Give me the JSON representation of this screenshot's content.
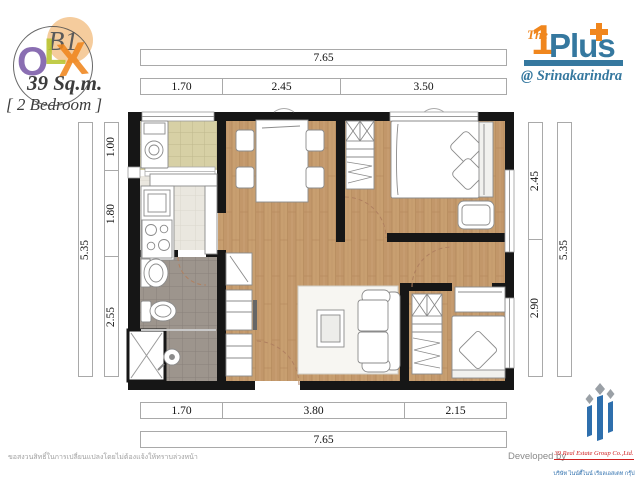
{
  "unit": {
    "code": "B1",
    "area": "39 Sq.m.",
    "type": "[ 2 Bedroom ]"
  },
  "watermark": {
    "letters": [
      "O",
      "L",
      "X"
    ]
  },
  "project": {
    "the": "The",
    "number": "1",
    "name": "Plus",
    "location": "@ Srinakarindra"
  },
  "dimensions": {
    "top_total": "7.65",
    "top_segments": [
      "1.70",
      "2.45",
      "3.50"
    ],
    "left_total": "5.35",
    "left_segments": [
      "1.00",
      "1.80",
      "2.55"
    ],
    "right_segments": [
      "2.45",
      "2.90"
    ],
    "right_total": "5.35",
    "bottom_segments": [
      "1.70",
      "3.80",
      "2.15"
    ],
    "bottom_total": "7.65"
  },
  "footer": {
    "disclaimer": "ขอสงวนสิทธิ์ในการเปลี่ยนแปลงโดยไม่ต้องแจ้งให้ทราบล่วงหน้า",
    "developed_by": "Developed by",
    "company_en": "39 Real Estate Group Co.,Ltd.",
    "company_th": "บริษัท ไนน์ตี้ไนน์ เรียลเอสเตท กรุ๊ป จำกัด"
  },
  "colors": {
    "brand_blue": "#35789f",
    "brand_orange": "#f0861d",
    "watermark_purple": "#7a5ba8",
    "watermark_green": "#b9c531",
    "wall_black": "#161616",
    "wood_floor": "#c89f70",
    "balcony_tile": "#d7d0a5",
    "kitchen_tile": "#eae7df",
    "bath_tile": "#9d958d",
    "company_red": "#cf2020",
    "company_blue": "#2e6fad"
  }
}
